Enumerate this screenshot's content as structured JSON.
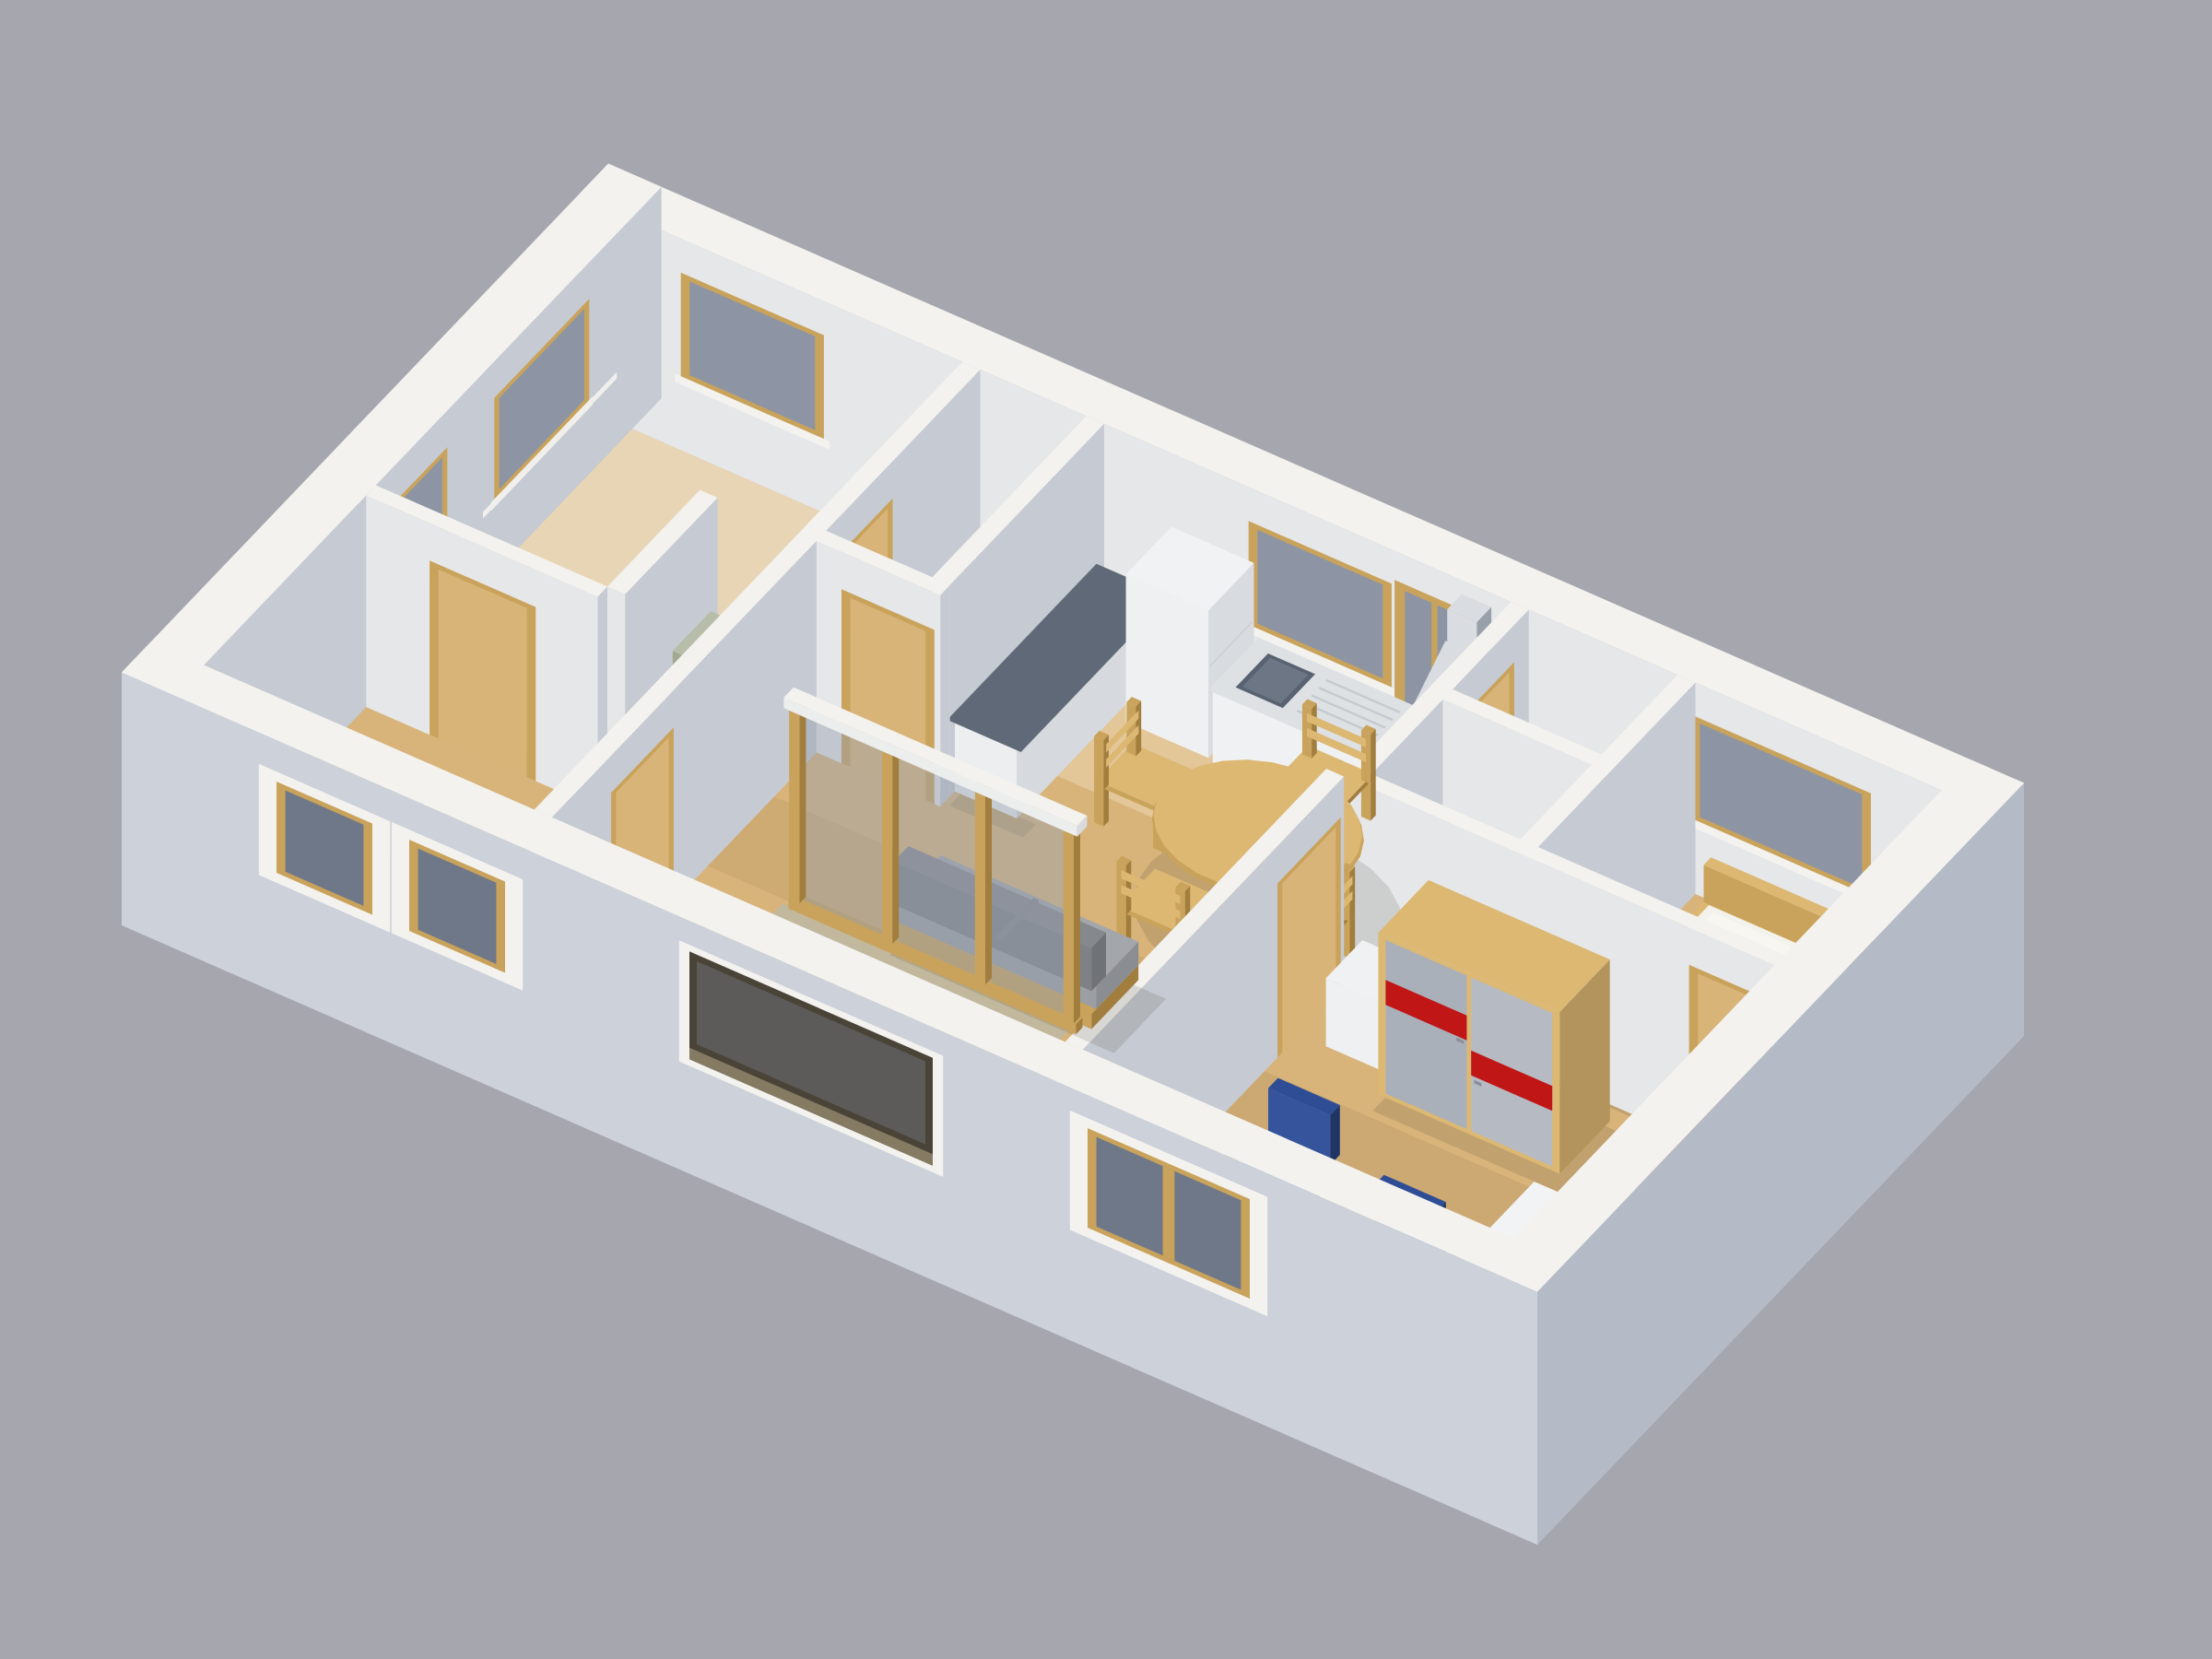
{
  "scene": {
    "type": "3d-floorplan-render",
    "description": "Isometric cutaway 3D rendering of an apartment floor plan viewed from above on a plain gray background",
    "background_color": "#a6a6ae",
    "counts": {
      "dining_chairs": 4,
      "office_chairs": 2
    },
    "rooms": [
      "top-left-room",
      "corridor",
      "utility-niche",
      "kitchen-dining-living",
      "wc",
      "shower-room",
      "bedroom",
      "office",
      "loggia",
      "entry-hall"
    ],
    "objects": [
      "kitchen-counter",
      "kitchen-sink",
      "refrigerator",
      "stove",
      "range-hood",
      "round-dining-table",
      "dining-chair",
      "sofa",
      "glazed-partition",
      "loggia-deck",
      "washing-machine",
      "boiler-cabinet",
      "shower-tray",
      "double-bed",
      "sliding-door-wardrobe",
      "red-cabinet",
      "desk",
      "office-chair",
      "window",
      "door"
    ],
    "palette": {
      "background": "#a6a6ae",
      "wall_top": "#f3f2ef",
      "wall_int_sw": "#e6e7e9",
      "wall_int_se": "#c6cad2",
      "ext_sw_face": "#ccd1da",
      "ext_se_face": "#b5bbc6",
      "floor": "#d8b47a",
      "deck": "#c2b89d",
      "deck_line": "#a89d82",
      "wood": "#c9a35b",
      "wood_dark": "#a17d3e",
      "wood_light": "#dcb873",
      "glass": "#8d95a4",
      "glass_dark": "#6e7888",
      "counter_top": "#5f6977",
      "metal_light": "#d9dce1",
      "metal_dark": "#9aa0aa",
      "sofa_back": "#85888d",
      "sofa_seat": "#a3a6aa",
      "bed_mattress": "#f4f2ec",
      "wardrobe_panel": "#aab0ba",
      "wardrobe_red": "#c01616",
      "chair_blue": "#2e4d95",
      "chair_blue_dark": "#1f3566",
      "chair_base": "#2b2f36",
      "washer_white": "#edeff0",
      "boiler_green": "#a3a893",
      "door_tan": "#d9b478",
      "shadow": "rgba(60,55,45,0.14)"
    }
  }
}
